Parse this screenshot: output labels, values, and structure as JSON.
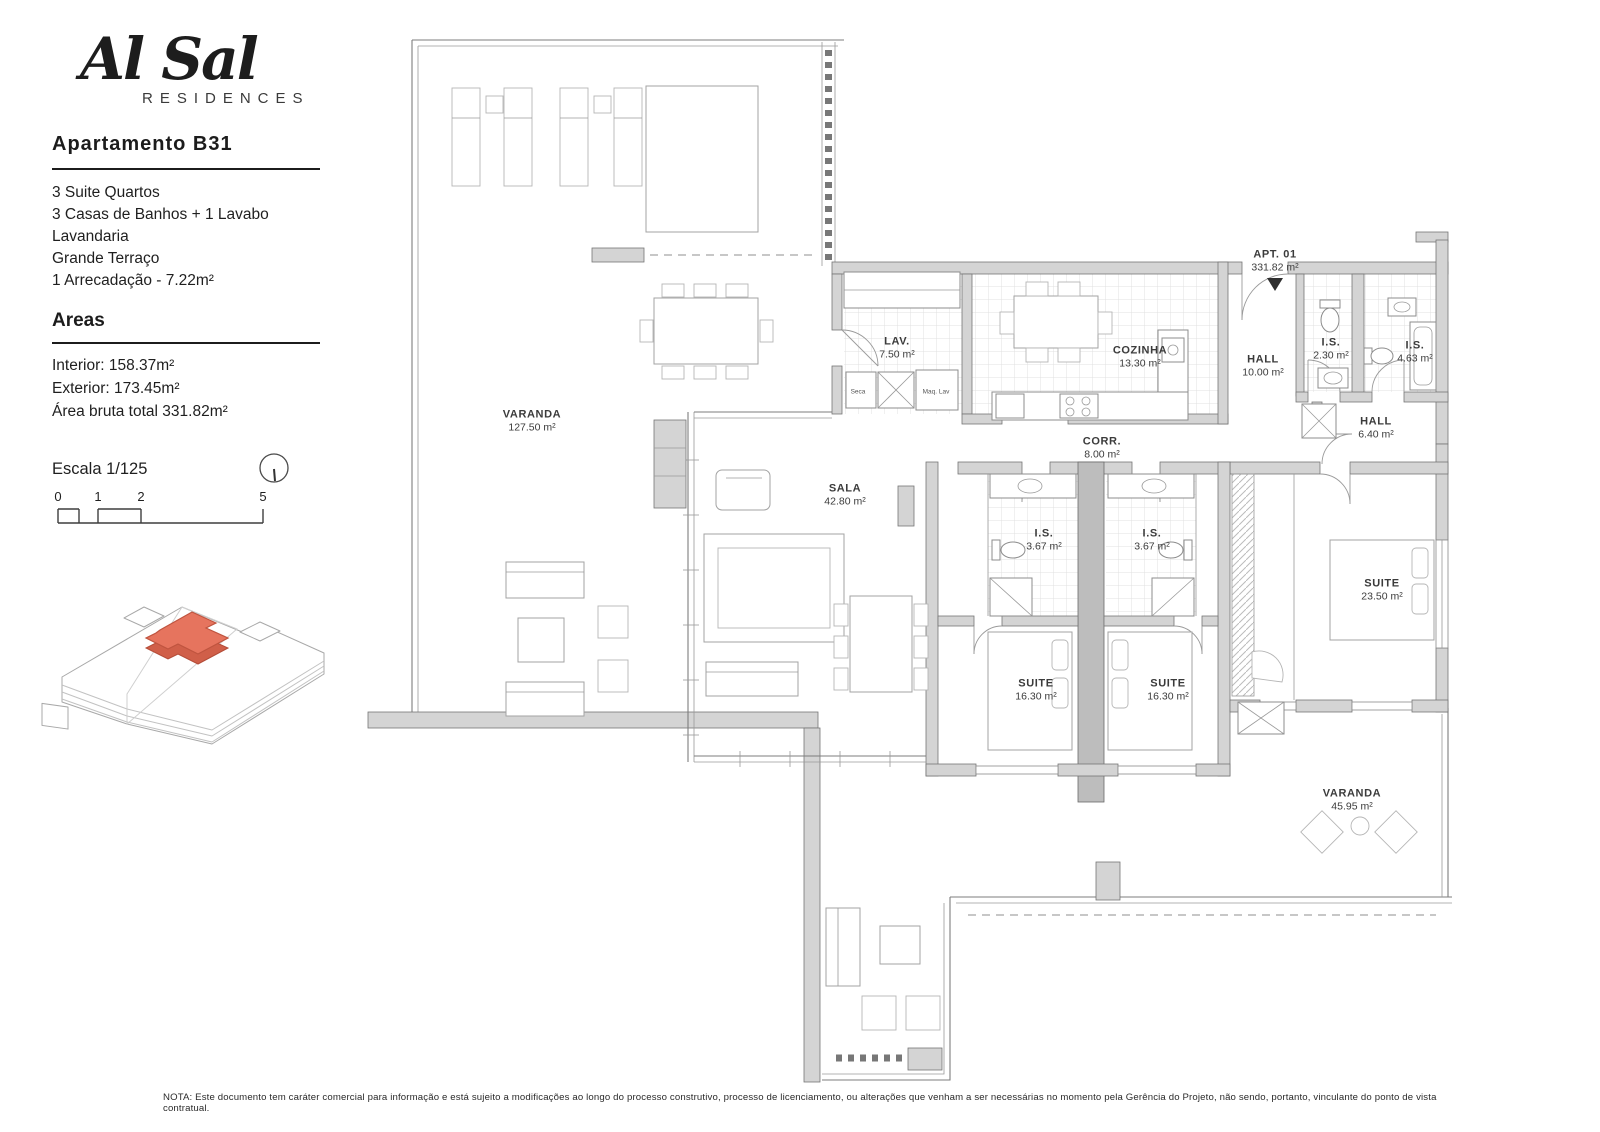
{
  "brand": {
    "name": "Al Sal",
    "subtitle": "RESIDENCES"
  },
  "apartment": {
    "title": "Apartamento  B31",
    "features": [
      "3 Suite Quartos",
      "3 Casas de Banhos + 1 Lavabo",
      "Lavandaria",
      "Grande Terraço",
      "1 Arrecadação - 7.22m²"
    ],
    "areas_title": "Areas",
    "areas": [
      "Interior: 158.37m²",
      "Exterior: 173.45m²",
      "Área  bruta total 331.82m²"
    ],
    "scale_label": "Escala 1/125",
    "scale_ticks": [
      "0",
      "1",
      "2",
      "5"
    ]
  },
  "plan": {
    "rooms": [
      {
        "id": "apt-01",
        "name": "APT. 01",
        "area": "331.82 m²",
        "x": 1275,
        "y": 261
      },
      {
        "id": "varanda-top",
        "name": "VARANDA",
        "area": "127.50 m²",
        "x": 532,
        "y": 421
      },
      {
        "id": "lav",
        "name": "LAV.",
        "area": "7.50 m²",
        "x": 897,
        "y": 348
      },
      {
        "id": "cozinha",
        "name": "COZINHA",
        "area": "13.30 m²",
        "x": 1140,
        "y": 357
      },
      {
        "id": "hall-10",
        "name": "HALL",
        "area": "10.00 m²",
        "x": 1263,
        "y": 366
      },
      {
        "id": "is-230",
        "name": "I.S.",
        "area": "2.30 m²",
        "x": 1331,
        "y": 349
      },
      {
        "id": "is-463",
        "name": "I.S.",
        "area": "4.63 m²",
        "x": 1415,
        "y": 352
      },
      {
        "id": "hall-640",
        "name": "HALL",
        "area": "6.40 m²",
        "x": 1376,
        "y": 428
      },
      {
        "id": "corr",
        "name": "CORR.",
        "area": "8.00 m²",
        "x": 1102,
        "y": 448
      },
      {
        "id": "sala",
        "name": "SALA",
        "area": "42.80 m²",
        "x": 845,
        "y": 495
      },
      {
        "id": "is-367-a",
        "name": "I.S.",
        "area": "3.67 m²",
        "x": 1044,
        "y": 540
      },
      {
        "id": "is-367-b",
        "name": "I.S.",
        "area": "3.67 m²",
        "x": 1152,
        "y": 540
      },
      {
        "id": "suite-a",
        "name": "SUITE",
        "area": "16.30 m²",
        "x": 1036,
        "y": 690
      },
      {
        "id": "suite-b",
        "name": "SUITE",
        "area": "16.30 m²",
        "x": 1168,
        "y": 690
      },
      {
        "id": "suite-master",
        "name": "SUITE",
        "area": "23.50 m²",
        "x": 1382,
        "y": 590
      },
      {
        "id": "varanda-bottom",
        "name": "VARANDA",
        "area": "45.95 m²",
        "x": 1352,
        "y": 800
      }
    ],
    "small_labels": [
      {
        "id": "seca",
        "text": "Seca",
        "x": 858,
        "y": 392
      },
      {
        "id": "maq-lav",
        "text": "Maq. Lav",
        "x": 936,
        "y": 392
      }
    ]
  },
  "note": "NOTA: Este documento tem caráter comercial para informação e está sujeito a modificações ao longo do processo construtivo, processo de licenciamento, ou alterações que venham a ser necessárias no momento pela Gerência do Projeto, não sendo, portanto, vinculante do ponto de vista contratual.",
  "colors": {
    "highlight": "#e6745e",
    "highlight_dark": "#c65b46",
    "wall": "#d4d4d4",
    "line": "#7d7d7d"
  }
}
